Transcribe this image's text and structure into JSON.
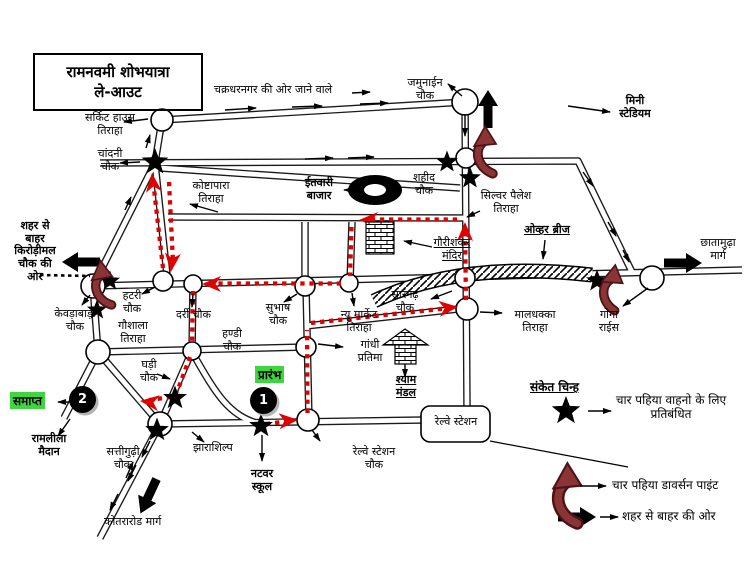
{
  "title": {
    "line1": "रामनवमी शोभयात्रा",
    "line2": "ले-आउट"
  },
  "labels": {
    "circuit_house": "सर्किट हाउस\nतिराहा",
    "chakradharnagar": "चक्रधरनगर की ओर जाने वाले",
    "jamunain": "जमुनाईन\nचौक",
    "mini_stadium": "मिनी\nस्टेडियम",
    "chandni": "चांदनी\nचौक",
    "koshtapara": "कोष्टापारा\nतिराहा",
    "itwari_bazar": "ईतवारी\nबाजार",
    "shahid": "शहीद\nचौक",
    "silver_palace": "सिल्वर पैलेश\nतिराहा",
    "over_bridge": "ओव्हर ब्रीज",
    "gaurishankar_mandir": "गौरीशंकर\nमंदिर",
    "chhatamudha": "छातामुढ़ा\nमार्ग",
    "sheher_se_bahar": "शहर से\nबाहर\nकिरोड़ीमल\nचौक की\nओर",
    "kevdabadi": "केवड़ाबाड़ी\nचौक",
    "hatri": "हटरी\nचौक",
    "gaushala": "गौशाला\nतिराहा",
    "darri": "दर्री चौक",
    "handi": "हण्डी\nचौक",
    "subhash": "सुभाष\nचौक",
    "new_market": "न्यू मार्केट\nतिराहा",
    "sarangarh": "सारंगढ़\nचौक",
    "maldhakka": "मालधक्का\nतिराहा",
    "goga_rice": "गोगा\nराईस",
    "gandhi_pratima": "गांधी\nप्रतिमा",
    "shyam_mandal": "श्याम\nमंडल",
    "ghadi": "घड़ी\nचौक",
    "ramlila_maidan": "रामलीला\nमैदान",
    "sattigudhi": "सत्तीगुढ़ी\nचौक",
    "kotra_road": "कोतरारोड मार्ग",
    "jharashilp": "झाराशिल्प",
    "natwar_school": "नटवर\nस्कूल",
    "railway_station_chowk": "रेल्वे स्टेशन\nचौक",
    "railway_station": "रेल्वे स्टेशन"
  },
  "markers": {
    "start_label": "प्रारंभ",
    "start_number": "1",
    "end_label": "समाप्त",
    "end_number": "2"
  },
  "legend": {
    "header": "संकेत चिन्ह",
    "items": [
      {
        "icon": "star-icon",
        "label": "चार पहिया वाहनो के लिए\nप्रतिबंधित"
      },
      {
        "icon": "curved-arrow-icon",
        "label": "चार पहिया डावर्सन पाइंट"
      },
      {
        "icon": "fat-arrow-icon",
        "label": "शहर से बाहर की ओर"
      }
    ]
  },
  "colors": {
    "route_red": "#e00000",
    "diversion_maroon": "#8a3436",
    "highlight_green": "#3ed63e",
    "road_outline": "#1a1a1a",
    "background": "#ffffff"
  }
}
